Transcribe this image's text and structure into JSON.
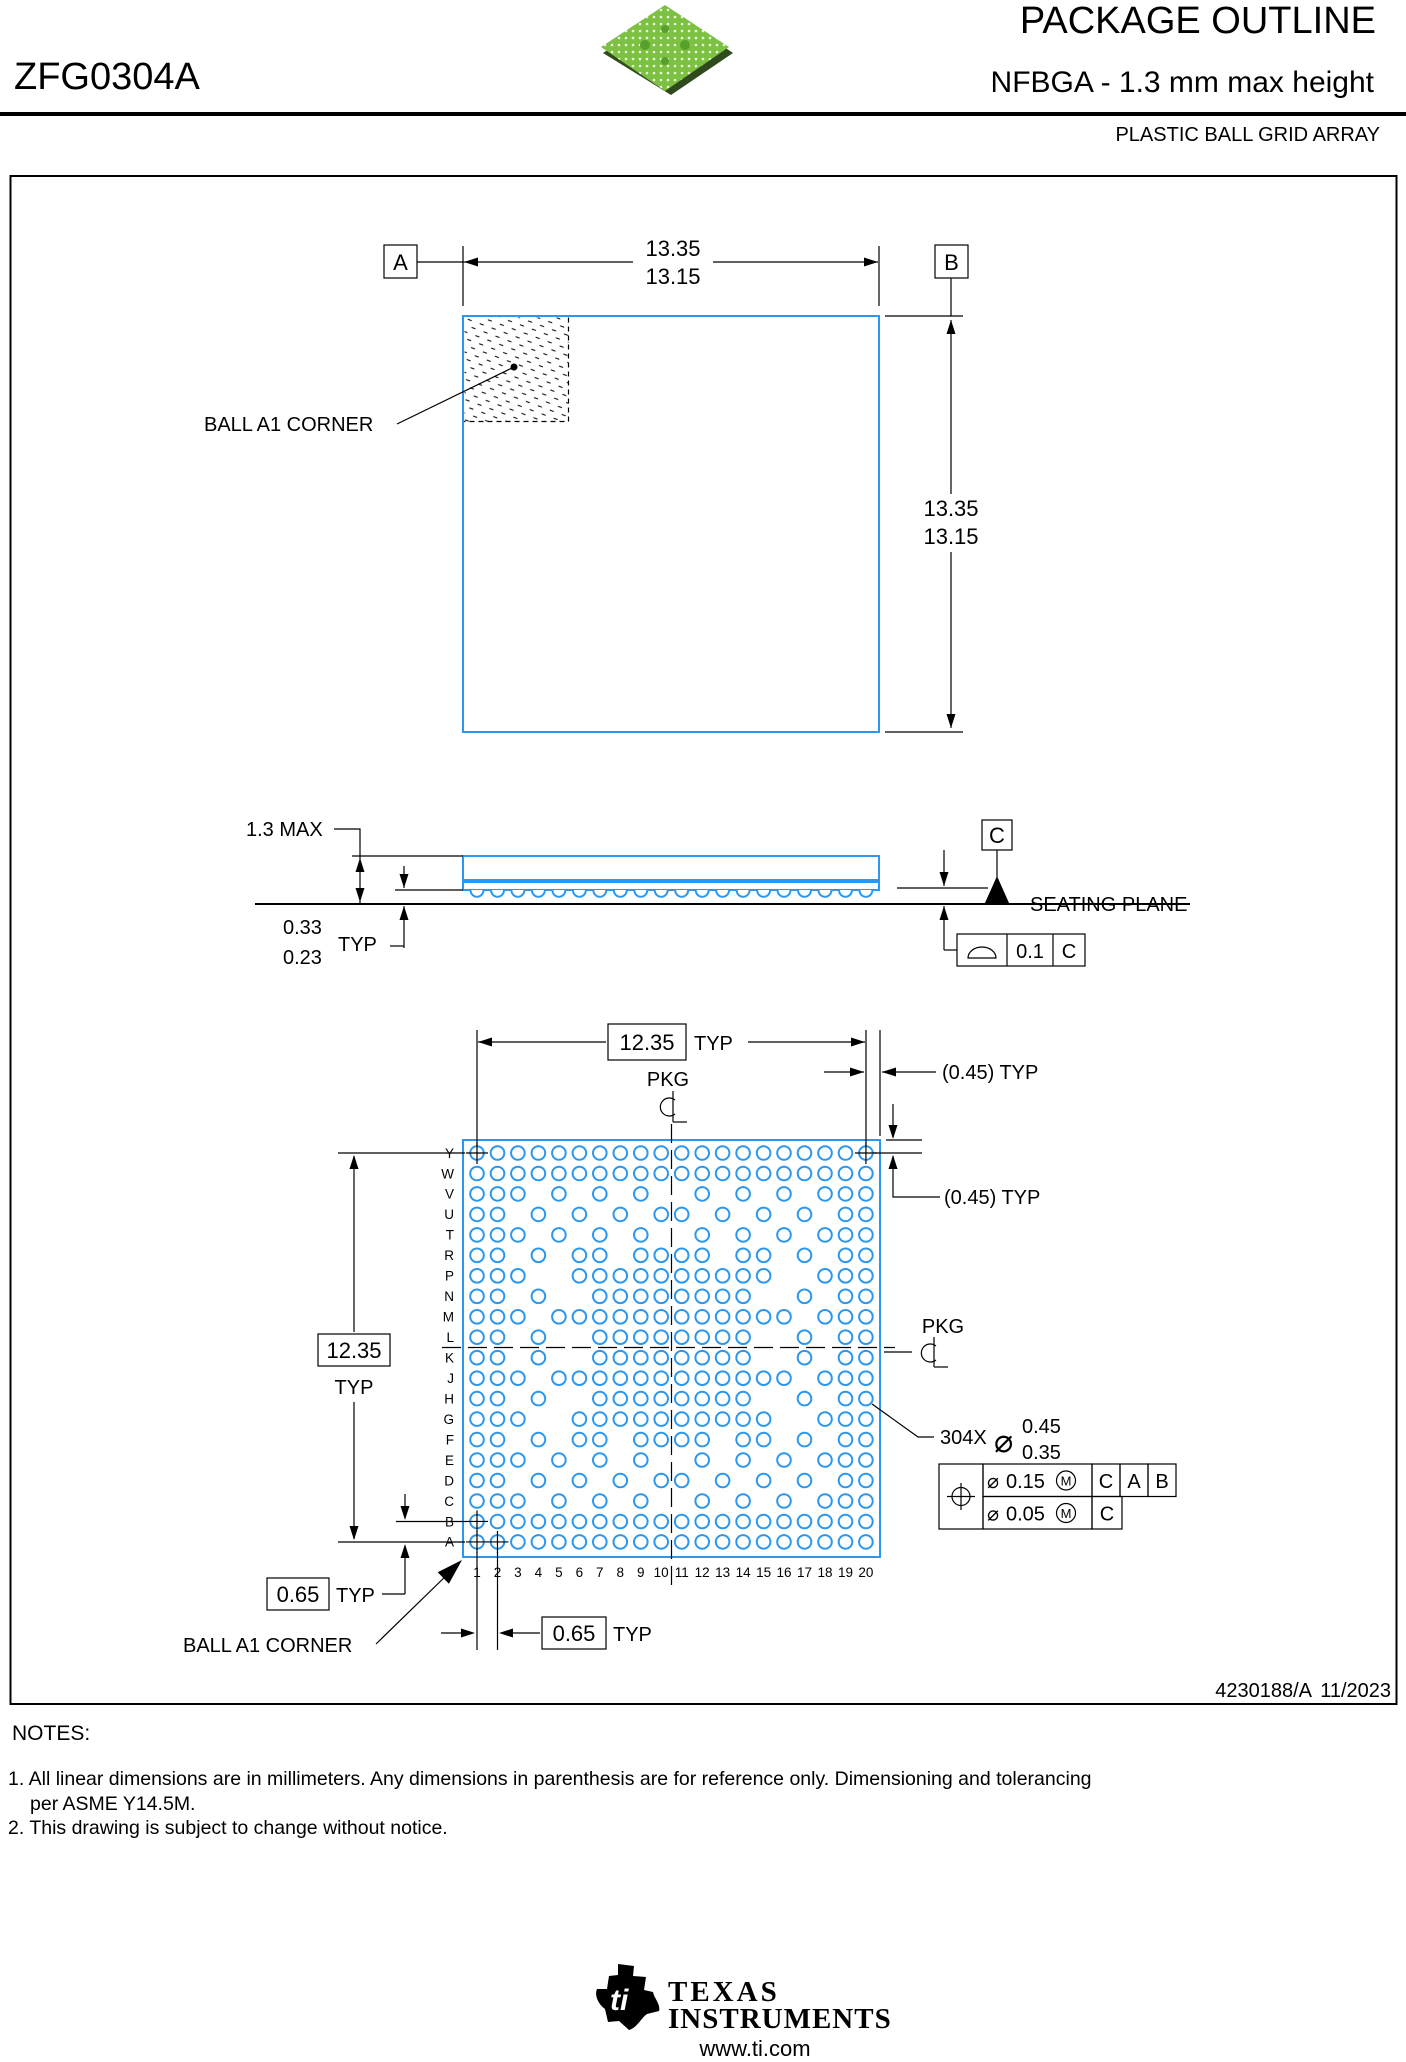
{
  "header": {
    "part_number": "ZFG0304A",
    "title": "PACKAGE OUTLINE",
    "subtitle": "NFBGA - 1.3 mm max height",
    "family": "PLASTIC BALL GRID ARRAY"
  },
  "top_view": {
    "datum_a": "A",
    "datum_b": "B",
    "width_dim": {
      "max": "13.35",
      "min": "13.15"
    },
    "height_dim": {
      "max": "13.35",
      "min": "13.15"
    },
    "ball_a1_label": "BALL A1 CORNER"
  },
  "side_view": {
    "height_max": "1.3 MAX",
    "ball_height": {
      "max": "0.33",
      "min": "0.23",
      "suffix": "TYP"
    },
    "datum_c": "C",
    "seating_plane": "SEATING PLANE",
    "flatness": {
      "value": "0.1",
      "datum": "C"
    }
  },
  "bottom_view": {
    "pitch_h": "12.35",
    "pitch_h_suffix": "TYP",
    "pitch_v": "12.35",
    "pitch_v_suffix": "TYP",
    "edge_gap_h": "(0.45) TYP",
    "edge_gap_v": "(0.45) TYP",
    "pkg_label_top": "PKG",
    "pkg_label_right": "PKG",
    "pitch_local": "0.65",
    "pitch_local_suffix": "TYP",
    "ball_a1_label": "BALL A1 CORNER",
    "ball_count": "304X",
    "ball_dia": {
      "max": "0.45",
      "min": "0.35"
    },
    "tolerance": {
      "position": {
        "value": "0.15",
        "modifier": "M",
        "datums": [
          "C",
          "A",
          "B"
        ]
      },
      "secondary": {
        "value": "0.05",
        "modifier": "M",
        "datum": "C"
      }
    },
    "rows": [
      "Y",
      "W",
      "V",
      "U",
      "T",
      "R",
      "P",
      "N",
      "M",
      "L",
      "K",
      "J",
      "H",
      "G",
      "F",
      "E",
      "D",
      "C",
      "B",
      "A"
    ],
    "cols": [
      "1",
      "2",
      "3",
      "4",
      "5",
      "6",
      "7",
      "8",
      "9",
      "10",
      "11",
      "12",
      "13",
      "14",
      "15",
      "16",
      "17",
      "18",
      "19",
      "20"
    ],
    "ball_map": [
      "11111111111111111111",
      "11111111111111111111",
      "11101010100101010111",
      "11010101011010101011",
      "11101010100101010111",
      "11010110111101101011",
      "11100111111111100111",
      "11010011111111001011",
      "11101111111111110111",
      "11010011111111001011",
      "11010011111111001011",
      "11101111111111110111",
      "11010011111111001011",
      "11100111111111100111",
      "11010110111101101011",
      "11101010100101010111",
      "11010101011010101011",
      "11101010100101010111",
      "11111111111111111111",
      "11111111111111111111"
    ],
    "crosshair_balls": [
      "Y1",
      "Y20",
      "B1",
      "A1",
      "A2"
    ]
  },
  "title_block": {
    "doc": "4230188/A",
    "date": "11/2023"
  },
  "notes": {
    "heading": "NOTES:",
    "line1": "1. All linear dimensions are in millimeters. Any dimensions in parenthesis are for reference only. Dimensioning and tolerancing",
    "line1b": "per ASME Y14.5M.",
    "line2": "2. This drawing is subject to change without notice."
  },
  "footer": {
    "brand_top": "Texas",
    "brand_bottom": "Instruments",
    "url": "www.ti.com"
  },
  "colors": {
    "outline_blue": "#2b97ee",
    "chip_green": "#7dc142",
    "black": "#000000"
  }
}
